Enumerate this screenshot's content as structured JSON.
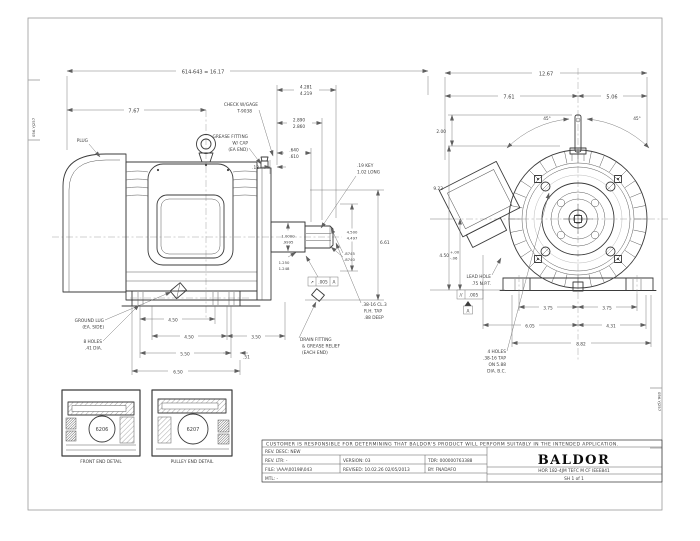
{
  "page": {
    "background": "#ffffff",
    "ink": "#3b3b3b"
  },
  "margins": {
    "left_label": "056.YJ257",
    "right_label": "056.YJ257"
  },
  "side_view": {
    "dim_overall": "614-643 = 16.17",
    "dim_lug": "7.67",
    "plug_label": "PLUG",
    "check_gage": [
      "CHECK W/GAGE",
      "T-9038"
    ],
    "grease_fitting": [
      "GREASE FITTING",
      "W/ CAP",
      "(EA END)"
    ],
    "dim_shaft_ext": [
      "4.281",
      "4.219"
    ],
    "dim_2890": [
      "2.890",
      "2.860"
    ],
    "dim_640": [
      ".640",
      ".610"
    ],
    "dim_13": ".13",
    "key_note": [
      ".19 KEY",
      "1.02 LONG"
    ],
    "dim_dia1": [
      "1.0000",
      ".9995"
    ],
    "dim_1250": [
      "1.250",
      "1.248"
    ],
    "dim_dia2": [
      ".8745",
      ".8740"
    ],
    "dim_4500": [
      "4.500",
      "4.497"
    ],
    "dim_height": "6.61",
    "gdt": {
      "symbol": "↗",
      "value": ".005",
      "datum": "A"
    },
    "tap_note": [
      ".38-16 CL.3",
      "R.H. TAP",
      ".88 DEEP"
    ],
    "ground_lug": [
      "GROUND LUG",
      "(EA. SIDE)"
    ],
    "holes_note": [
      "8 HOLES",
      ".41 DIA."
    ],
    "drain_note": [
      "DRAIN FITTING",
      "& GREASE RELIEF",
      "(EACH END)"
    ],
    "dim_f1": "4.50",
    "dim_f2": "4.50",
    "dim_f3": "3.50",
    "dim_f4": "5.50",
    "dim_f5": ".51",
    "dim_f6": "6.50"
  },
  "end_view": {
    "dim_width": "12.67",
    "dim_left": "7.61",
    "dim_right": "5.06",
    "angle_left": "45°",
    "angle_right": "45°",
    "dim_top": "2.00",
    "dim_height": "9.23",
    "dim_d": "4.50",
    "dim_d_tol_plus": "+.00",
    "dim_d_tol_minus": "-.06",
    "lead_hole": [
      "LEAD HOLE",
      ".75 N.P.T."
    ],
    "gdt": {
      "symbol": "//",
      "value": ".005",
      "datum": "A"
    },
    "dim_e1": "3.75",
    "dim_e2": "3.75",
    "dim_ab": "6.05",
    "dim_rb": "4.31",
    "dim_base": "8.82",
    "holes_note": [
      "4 HOLES",
      ".38-16 TAP",
      "ON 5.88",
      "DIA. B.C."
    ]
  },
  "details": {
    "front": {
      "bearing": "6206",
      "caption": "FRONT END DETAIL"
    },
    "pulley": {
      "bearing": "6207",
      "caption": "PULLEY END DETAIL"
    }
  },
  "title_block": {
    "disclaimer": "CUSTOMER IS RESPONSIBLE FOR DETERMINING THAT BALDOR'S PRODUCT WILL PERFORM SUITABLY IN THE INTENDED APPLICATION.",
    "rev_desc": "REV. DESC:  NEW",
    "rev_ltr": "REV. LTR:  -",
    "version": "VERSION: 03",
    "tdr": "TDR: 000000763388",
    "file": "FILE: \\AAA\\00198\\043",
    "revised": "REVISED: 10.02.26  02/05/2013",
    "by": "BY:  FNADAFO",
    "mtl": "MTL: -",
    "logo": "BALDOR",
    "model": "HOR 182-4JM TEFC M CF IEEE841",
    "sheet": "SH 1 of 1"
  }
}
